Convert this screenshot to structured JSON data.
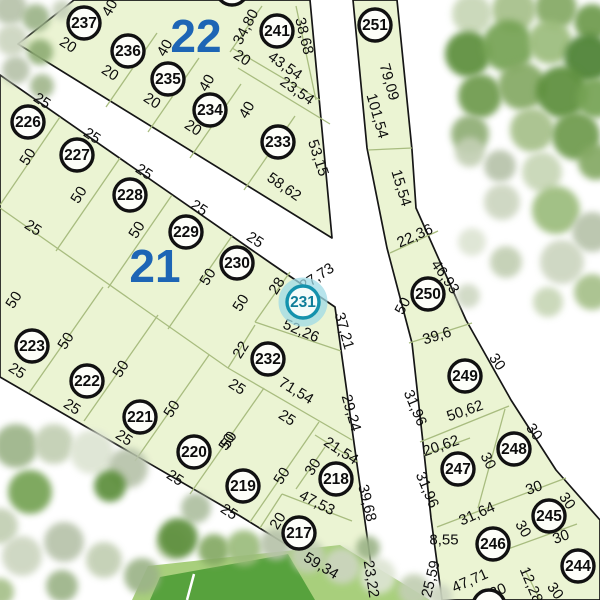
{
  "map": {
    "selected_parcel": "231",
    "colors": {
      "road": "#ffffff",
      "parcel_fill": "#ebf4d3",
      "parcel_inner_line": "#a8bc7f",
      "boundary": "#161616",
      "block_label": "#1d65b5",
      "selected_ring": "#1492ad",
      "selected_halo": "#9fdbe6",
      "field_outer": "#a8cf7c",
      "field_inner": "#57a23d"
    },
    "block_labels": [
      {
        "label": "22",
        "x": 196,
        "y": 36
      },
      {
        "label": "21",
        "x": 155,
        "y": 266
      }
    ],
    "parcels": [
      {
        "number": "237",
        "x": 84,
        "y": 23
      },
      {
        "number": "236",
        "x": 128,
        "y": 51
      },
      {
        "number": "235",
        "x": 168,
        "y": 79
      },
      {
        "number": "234",
        "x": 210,
        "y": 110
      },
      {
        "number": "233",
        "x": 278,
        "y": 142
      },
      {
        "number": "241",
        "x": 277,
        "y": 31
      },
      {
        "number": "251",
        "x": 375,
        "y": 25
      },
      {
        "number": "226",
        "x": 28,
        "y": 122
      },
      {
        "number": "227",
        "x": 77,
        "y": 155
      },
      {
        "number": "228",
        "x": 130,
        "y": 195
      },
      {
        "number": "229",
        "x": 186,
        "y": 232
      },
      {
        "number": "230",
        "x": 237,
        "y": 263
      },
      {
        "number": "231",
        "x": 303,
        "y": 302,
        "selected": true
      },
      {
        "number": "232",
        "x": 268,
        "y": 359
      },
      {
        "number": "223",
        "x": 32,
        "y": 346
      },
      {
        "number": "222",
        "x": 87,
        "y": 381
      },
      {
        "number": "221",
        "x": 140,
        "y": 417
      },
      {
        "number": "220",
        "x": 194,
        "y": 452
      },
      {
        "number": "219",
        "x": 243,
        "y": 486
      },
      {
        "number": "218",
        "x": 336,
        "y": 479
      },
      {
        "number": "217",
        "x": 299,
        "y": 533
      },
      {
        "number": "250",
        "x": 428,
        "y": 294
      },
      {
        "number": "249",
        "x": 465,
        "y": 376
      },
      {
        "number": "247",
        "x": 458,
        "y": 469
      },
      {
        "number": "248",
        "x": 514,
        "y": 449
      },
      {
        "number": "245",
        "x": 549,
        "y": 516
      },
      {
        "number": "246",
        "x": 493,
        "y": 544
      },
      {
        "number": "244",
        "x": 578,
        "y": 566
      }
    ],
    "partial_markers": [
      {
        "x": 232,
        "y": -11
      },
      {
        "x": 489,
        "y": 606
      }
    ],
    "dimensions": [
      {
        "t": "40",
        "x": 110,
        "y": 8,
        "r": -60
      },
      {
        "t": "20",
        "x": 68,
        "y": 45,
        "r": 33
      },
      {
        "t": "20",
        "x": 110,
        "y": 73,
        "r": 33
      },
      {
        "t": "20",
        "x": 152,
        "y": 101,
        "r": 33
      },
      {
        "t": "20",
        "x": 193,
        "y": 128,
        "r": 33
      },
      {
        "t": "40",
        "x": 165,
        "y": 48,
        "r": -60
      },
      {
        "t": "40",
        "x": 207,
        "y": 83,
        "r": -60
      },
      {
        "t": "40",
        "x": 247,
        "y": 110,
        "r": -60
      },
      {
        "t": "20",
        "x": 242,
        "y": 58,
        "r": 33
      },
      {
        "t": "34,80",
        "x": 246,
        "y": 27,
        "r": -62
      },
      {
        "t": "38,68",
        "x": 304,
        "y": 36,
        "r": 76
      },
      {
        "t": "43,54",
        "x": 285,
        "y": 66,
        "r": 35
      },
      {
        "t": "23,54",
        "x": 297,
        "y": 91,
        "r": 35
      },
      {
        "t": "53,15",
        "x": 318,
        "y": 158,
        "r": 72
      },
      {
        "t": "58,62",
        "x": 284,
        "y": 187,
        "r": 35
      },
      {
        "t": "79,09",
        "x": 389,
        "y": 82,
        "r": 74
      },
      {
        "t": "101,54",
        "x": 377,
        "y": 116,
        "r": 74
      },
      {
        "t": "15,54",
        "x": 401,
        "y": 188,
        "r": 73
      },
      {
        "t": "22,36",
        "x": 415,
        "y": 236,
        "r": -24
      },
      {
        "t": "46,93",
        "x": 445,
        "y": 277,
        "r": 55
      },
      {
        "t": "50",
        "x": 403,
        "y": 306,
        "r": -62
      },
      {
        "t": "39,6",
        "x": 437,
        "y": 336,
        "r": -17
      },
      {
        "t": "30",
        "x": 497,
        "y": 362,
        "r": 55
      },
      {
        "t": "31,96",
        "x": 415,
        "y": 408,
        "r": 67
      },
      {
        "t": "50,62",
        "x": 465,
        "y": 411,
        "r": -19
      },
      {
        "t": "30",
        "x": 534,
        "y": 432,
        "r": 55
      },
      {
        "t": "20,62",
        "x": 441,
        "y": 446,
        "r": -19
      },
      {
        "t": "31,96",
        "x": 427,
        "y": 490,
        "r": 67
      },
      {
        "t": "30",
        "x": 488,
        "y": 461,
        "r": 62
      },
      {
        "t": "31,64",
        "x": 477,
        "y": 514,
        "r": -24
      },
      {
        "t": "8,55",
        "x": 444,
        "y": 540,
        "r": 0
      },
      {
        "t": "30",
        "x": 534,
        "y": 488,
        "r": -20
      },
      {
        "t": "30",
        "x": 567,
        "y": 501,
        "r": 55
      },
      {
        "t": "30",
        "x": 523,
        "y": 529,
        "r": 60
      },
      {
        "t": "30",
        "x": 561,
        "y": 537,
        "r": -20
      },
      {
        "t": "47,71",
        "x": 470,
        "y": 581,
        "r": -24
      },
      {
        "t": "30",
        "x": 498,
        "y": 591,
        "r": -24
      },
      {
        "t": "12,28",
        "x": 531,
        "y": 585,
        "r": 67
      },
      {
        "t": "30",
        "x": 555,
        "y": 591,
        "r": 55
      },
      {
        "t": "25,59",
        "x": 431,
        "y": 579,
        "r": -76
      },
      {
        "t": "25",
        "x": 42,
        "y": 101,
        "r": 33
      },
      {
        "t": "50",
        "x": 28,
        "y": 157,
        "r": -58
      },
      {
        "t": "25",
        "x": 92,
        "y": 136,
        "r": 33
      },
      {
        "t": "50",
        "x": 79,
        "y": 195,
        "r": -58
      },
      {
        "t": "25",
        "x": 144,
        "y": 172,
        "r": 33
      },
      {
        "t": "50",
        "x": 137,
        "y": 230,
        "r": -58
      },
      {
        "t": "25",
        "x": 199,
        "y": 208,
        "r": 33
      },
      {
        "t": "50",
        "x": 208,
        "y": 277,
        "r": -58
      },
      {
        "t": "25",
        "x": 255,
        "y": 240,
        "r": 33
      },
      {
        "t": "50",
        "x": 241,
        "y": 303,
        "r": -58
      },
      {
        "t": "28",
        "x": 277,
        "y": 286,
        "r": -58
      },
      {
        "t": "27,73",
        "x": 317,
        "y": 277,
        "r": -33
      },
      {
        "t": "52,26",
        "x": 301,
        "y": 331,
        "r": 23
      },
      {
        "t": "37,21",
        "x": 344,
        "y": 331,
        "r": 74
      },
      {
        "t": "25",
        "x": 33,
        "y": 228,
        "r": 33
      },
      {
        "t": "22",
        "x": 241,
        "y": 350,
        "r": -58
      },
      {
        "t": "71,54",
        "x": 296,
        "y": 391,
        "r": 31
      },
      {
        "t": "25",
        "x": 237,
        "y": 387,
        "r": 33
      },
      {
        "t": "25",
        "x": 287,
        "y": 418,
        "r": 33
      },
      {
        "t": "50",
        "x": 229,
        "y": 440,
        "r": -58
      },
      {
        "t": "29,24",
        "x": 351,
        "y": 413,
        "r": 74
      },
      {
        "t": "21,54",
        "x": 341,
        "y": 451,
        "r": 33
      },
      {
        "t": "30",
        "x": 313,
        "y": 467,
        "r": -58
      },
      {
        "t": "39,68",
        "x": 367,
        "y": 503,
        "r": 76
      },
      {
        "t": "47,53",
        "x": 317,
        "y": 503,
        "r": 27
      },
      {
        "t": "20",
        "x": 278,
        "y": 521,
        "r": -58
      },
      {
        "t": "59,34",
        "x": 321,
        "y": 566,
        "r": 31
      },
      {
        "t": "23,22",
        "x": 371,
        "y": 579,
        "r": 81
      },
      {
        "t": "50",
        "x": 14,
        "y": 300,
        "r": -58
      },
      {
        "t": "50",
        "x": 66,
        "y": 341,
        "r": -58
      },
      {
        "t": "50",
        "x": 121,
        "y": 369,
        "r": -58
      },
      {
        "t": "50",
        "x": 172,
        "y": 409,
        "r": -58
      },
      {
        "t": "50",
        "x": 227,
        "y": 442,
        "r": -58
      },
      {
        "t": "50",
        "x": 282,
        "y": 476,
        "r": -58
      },
      {
        "t": "25",
        "x": 17,
        "y": 371,
        "r": 33
      },
      {
        "t": "25",
        "x": 72,
        "y": 407,
        "r": 33
      },
      {
        "t": "25",
        "x": 124,
        "y": 438,
        "r": 33
      },
      {
        "t": "25",
        "x": 175,
        "y": 478,
        "r": 33
      },
      {
        "t": "25",
        "x": 229,
        "y": 512,
        "r": 33
      }
    ],
    "land_polygons": [
      {
        "name": "block-22",
        "points": "74,0 310,0 332,238 18,44"
      },
      {
        "name": "block-21",
        "points": "0,75 272,264 335,307 376,600 240,516 0,377"
      },
      {
        "name": "block-right",
        "points": "353,0 397,0 412,150 416,208 466,320 511,400 556,470 600,520 600,600 442,600 431,518 424,452 412,343 387,248 367,148"
      }
    ],
    "inner_lines": [
      [
        106,
        107,
        157,
        33
      ],
      [
        148,
        132,
        199,
        58
      ],
      [
        190,
        158,
        241,
        84
      ],
      [
        244,
        190,
        295,
        116
      ],
      [
        262,
        6,
        230,
        52
      ],
      [
        232,
        48,
        320,
        100
      ],
      [
        238,
        68,
        330,
        124
      ],
      [
        296,
        6,
        316,
        100
      ],
      [
        60,
        117,
        0,
        205
      ],
      [
        120,
        158,
        56,
        251
      ],
      [
        172,
        195,
        108,
        288
      ],
      [
        232,
        236,
        168,
        329
      ],
      [
        290,
        272,
        255,
        322
      ],
      [
        0,
        208,
        228,
        368
      ],
      [
        228,
        368,
        352,
        440
      ],
      [
        255,
        322,
        341,
        351
      ],
      [
        255,
        325,
        228,
        368
      ],
      [
        103,
        287,
        29,
        393
      ],
      [
        158,
        315,
        84,
        421
      ],
      [
        209,
        355,
        135,
        461
      ],
      [
        264,
        388,
        190,
        494
      ],
      [
        319,
        422,
        250,
        522
      ],
      [
        315,
        435,
        358,
        462
      ],
      [
        325,
        447,
        296,
        489
      ],
      [
        282,
        494,
        352,
        521
      ],
      [
        282,
        494,
        260,
        528
      ],
      [
        368,
        150,
        412,
        148
      ],
      [
        390,
        253,
        438,
        231
      ],
      [
        409,
        343,
        472,
        323
      ],
      [
        420,
        442,
        509,
        406
      ],
      [
        505,
        409,
        478,
        508
      ],
      [
        424,
        455,
        470,
        438
      ],
      [
        437,
        527,
        500,
        503
      ],
      [
        500,
        503,
        566,
        478
      ],
      [
        505,
        550,
        577,
        524
      ],
      [
        525,
        570,
        540,
        600
      ]
    ],
    "field": {
      "outer": "132,600 148,566 340,545 430,600",
      "inner": "150,600 160,577 288,554 315,600",
      "line": [
        194,
        574,
        187,
        600
      ]
    },
    "trees": [
      {
        "x": 10,
        "y": 8,
        "rad": 17,
        "c": "#b7c3aa"
      },
      {
        "x": 36,
        "y": 18,
        "rad": 14,
        "c": "#9cb488"
      },
      {
        "x": 12,
        "y": 40,
        "rad": 16,
        "c": "#ccd5c0"
      },
      {
        "x": 40,
        "y": 52,
        "rad": 13,
        "c": "#8fad74"
      },
      {
        "x": 16,
        "y": 70,
        "rad": 14,
        "c": "#b7c3aa"
      },
      {
        "x": 42,
        "y": 86,
        "rad": 12,
        "c": "#a2b78d"
      },
      {
        "x": 62,
        "y": 10,
        "rad": 10,
        "c": "#c6d0ba"
      },
      {
        "x": 472,
        "y": 14,
        "rad": 20,
        "c": "#c7d6b6"
      },
      {
        "x": 514,
        "y": 10,
        "rad": 22,
        "c": "#a6c089"
      },
      {
        "x": 556,
        "y": 8,
        "rad": 21,
        "c": "#84a963"
      },
      {
        "x": 592,
        "y": 22,
        "rad": 18,
        "c": "#6d9a4b"
      },
      {
        "x": 468,
        "y": 54,
        "rad": 23,
        "c": "#5c8e3a"
      },
      {
        "x": 508,
        "y": 46,
        "rad": 26,
        "c": "#74a252"
      },
      {
        "x": 550,
        "y": 42,
        "rad": 22,
        "c": "#9bbc7c"
      },
      {
        "x": 588,
        "y": 58,
        "rad": 24,
        "c": "#4c8130"
      },
      {
        "x": 480,
        "y": 96,
        "rad": 22,
        "c": "#6d9a4b"
      },
      {
        "x": 522,
        "y": 86,
        "rad": 24,
        "c": "#84a963"
      },
      {
        "x": 562,
        "y": 92,
        "rad": 26,
        "c": "#5c8e3a"
      },
      {
        "x": 596,
        "y": 98,
        "rad": 20,
        "c": "#74a252"
      },
      {
        "x": 470,
        "y": 134,
        "rad": 19,
        "c": "#8fad74"
      },
      {
        "x": 532,
        "y": 130,
        "rad": 22,
        "c": "#a6c089"
      },
      {
        "x": 576,
        "y": 136,
        "rad": 24,
        "c": "#6d9a4b"
      },
      {
        "x": 596,
        "y": 162,
        "rad": 18,
        "c": "#84a963"
      },
      {
        "x": 542,
        "y": 172,
        "rad": 20,
        "c": "#c7d6b6"
      },
      {
        "x": 500,
        "y": 166,
        "rad": 16,
        "c": "#b7c3aa"
      },
      {
        "x": 556,
        "y": 210,
        "rad": 24,
        "c": "#9bbc7c"
      },
      {
        "x": 592,
        "y": 232,
        "rad": 20,
        "c": "#b7c3aa"
      },
      {
        "x": 562,
        "y": 262,
        "rad": 22,
        "c": "#ccd5c0"
      },
      {
        "x": 592,
        "y": 292,
        "rad": 18,
        "c": "#a6c089"
      },
      {
        "x": 548,
        "y": 302,
        "rad": 15,
        "c": "#c7d6b6"
      },
      {
        "x": 470,
        "y": 152,
        "rad": 15,
        "c": "#c2cfb3"
      },
      {
        "x": 502,
        "y": 202,
        "rad": 18,
        "c": "#ccd5c0"
      },
      {
        "x": 472,
        "y": 242,
        "rad": 14,
        "c": "#dde4d3"
      },
      {
        "x": 506,
        "y": 262,
        "rad": 16,
        "c": "#c2cfb3"
      },
      {
        "x": 468,
        "y": 296,
        "rad": 12,
        "c": "#cfd8c3"
      },
      {
        "x": 16,
        "y": 446,
        "rad": 22,
        "c": "#9cb488"
      },
      {
        "x": 54,
        "y": 444,
        "rad": 20,
        "c": "#c2cfb3"
      },
      {
        "x": 92,
        "y": 452,
        "rad": 22,
        "c": "#dde4d3"
      },
      {
        "x": 128,
        "y": 468,
        "rad": 20,
        "c": "#b7c3aa"
      },
      {
        "x": 110,
        "y": 486,
        "rad": 16,
        "c": "#5c8e3a"
      },
      {
        "x": 30,
        "y": 492,
        "rad": 22,
        "c": "#74a252"
      },
      {
        "x": 0,
        "y": 526,
        "rad": 18,
        "c": "#c2cfb3"
      },
      {
        "x": 22,
        "y": 556,
        "rad": 20,
        "c": "#ccd5c0"
      },
      {
        "x": 64,
        "y": 542,
        "rad": 20,
        "c": "#b7c3aa"
      },
      {
        "x": 104,
        "y": 560,
        "rad": 18,
        "c": "#c2cfb3"
      },
      {
        "x": 62,
        "y": 586,
        "rad": 16,
        "c": "#9cb488"
      },
      {
        "x": 0,
        "y": 592,
        "rad": 14,
        "c": "#a6c089"
      },
      {
        "x": 142,
        "y": 576,
        "rad": 18,
        "c": "#9cb488"
      },
      {
        "x": 172,
        "y": 544,
        "rad": 16,
        "c": "#c7d6b6"
      },
      {
        "x": 196,
        "y": 508,
        "rad": 15,
        "c": "#aebfa0"
      },
      {
        "x": 178,
        "y": 538,
        "rad": 20,
        "c": "#5c8e3a"
      },
      {
        "x": 214,
        "y": 550,
        "rad": 16,
        "c": "#84a963"
      },
      {
        "x": 244,
        "y": 548,
        "rad": 18,
        "c": "#9bbc7c"
      },
      {
        "x": 276,
        "y": 544,
        "rad": 16,
        "c": "#b7c3aa"
      },
      {
        "x": 308,
        "y": 556,
        "rad": 17,
        "c": "#c2cfb3"
      },
      {
        "x": 342,
        "y": 566,
        "rad": 18,
        "c": "#ccd5c0"
      },
      {
        "x": 378,
        "y": 576,
        "rad": 18,
        "c": "#dde4d3"
      },
      {
        "x": 414,
        "y": 590,
        "rad": 16,
        "c": "#c2cfb3"
      },
      {
        "x": 368,
        "y": 548,
        "rad": 12,
        "c": "#9cb488"
      },
      {
        "x": 440,
        "y": 596,
        "rad": 12,
        "c": "#ccd5c0"
      }
    ]
  }
}
